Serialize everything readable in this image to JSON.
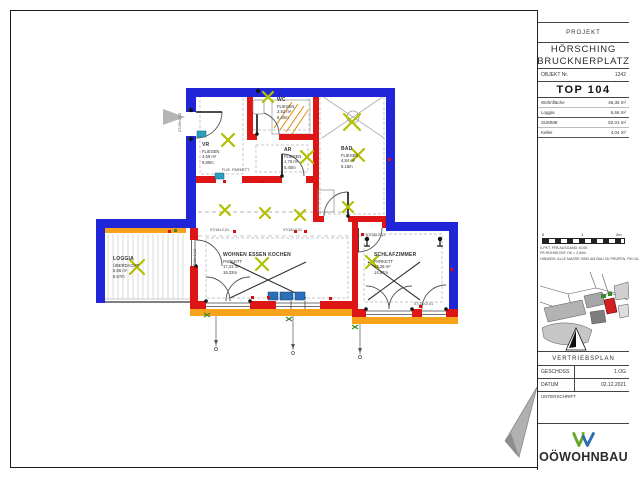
{
  "titleblock": {
    "projekt_label": "PROJEKT",
    "project_line1": "HÖRSCHING",
    "project_line2": "BRUCKNERPLATZ",
    "objekt_label": "OBJEKT Nr.",
    "objekt_value": "1242",
    "unit": "TOP 104",
    "areas": [
      {
        "label": "Wohnfläche",
        "value": "46,35 m²"
      },
      {
        "label": "Loggia",
        "value": "5,66 m²"
      },
      {
        "label": "SUMME",
        "value": "52,01 m²"
      },
      {
        "label": "Keller",
        "value": "4,04 m²"
      }
    ],
    "scale_ticks": [
      "0",
      "1",
      "2m"
    ],
    "notes": [
      "0-PKT. FFB AUSGANG ±0,00",
      "FB ROHDECKE OK = 2,80m",
      "HINWEIS: ALLE MASSE SIND AM BAU ZU PRÜFEN, RH CA. 2,50m"
    ],
    "plan_type": "VERTRIEBSPLAN",
    "geschoss_label": "GESCHOSS",
    "geschoss_value": "1.OG",
    "datum_label": "DATUM",
    "datum_value": "02.12.2021",
    "unterschrift_label": "UNTERSCHRIFT",
    "brand": "OÖWOHNBAU"
  },
  "rooms": [
    {
      "name": "VR",
      "floor": "FLIESEN",
      "area": "4,59 m²",
      "perimeter": "8,80m"
    },
    {
      "name": "WC",
      "floor": "FLIESEN",
      "area": "2,52 m²",
      "perimeter": "6,40m"
    },
    {
      "name": "AR",
      "floor": "FLIESEN",
      "area": "1,76 m²",
      "perimeter": "5,40m"
    },
    {
      "name": "BAD",
      "floor": "FLIESEN",
      "area": "4,84 m²",
      "perimeter": "8,18m"
    },
    {
      "name": "WOHNEN ESSEN KOCHEN",
      "floor": "PARKETT",
      "area": "17,23 m²",
      "perimeter": "19,33m"
    },
    {
      "name": "SCHLAFZIMMER",
      "floor": "PARKETT",
      "area": "13,28 m²",
      "perimeter": "14,67m"
    },
    {
      "name": "LOGGIA",
      "floor": "ÜBERDACHT",
      "area": "5,66 m²",
      "perimeter": "9,67m"
    }
  ],
  "dims": {
    "window_door": "07/18×2,01",
    "door_left": "27/18×2,13",
    "floor_change": "FLIE. PARKETT"
  },
  "colors": {
    "wall_exterior": "#2026d8",
    "wall_interior": "#dd1515",
    "insulation": "#f6a21a",
    "light_symbol": "#b3bf00",
    "highlight_unit": "#d22020",
    "logo_green": "#64a825",
    "logo_blue": "#2e6db4"
  }
}
